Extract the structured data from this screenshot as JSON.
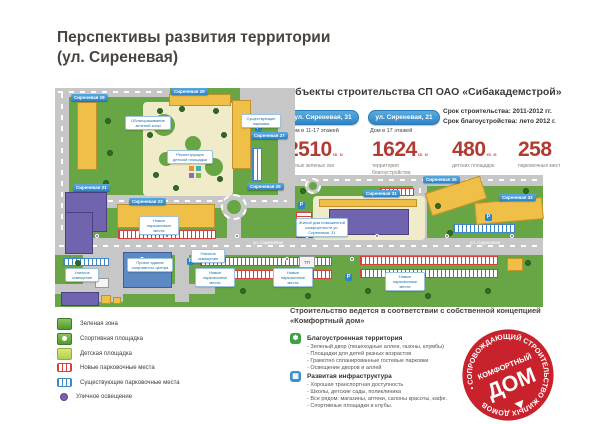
{
  "title": {
    "line1": "Перспективы развития территории",
    "line2": "(ул. Сиреневая)"
  },
  "objects": {
    "heading": "Объекты строительства СП ОАО «Сибакадемстрой»",
    "buildings": [
      {
        "button": "ул. Сиреневая, 31",
        "subtitle": "Дом в 11-17 этажей"
      },
      {
        "button": "ул. Сиреневая, 21",
        "subtitle": "Дом в 17 этажей"
      }
    ],
    "terms": [
      "Срок строительства: 2011-2012 гг.",
      "Срок благоустройства: лето 2012 г."
    ],
    "stats": [
      {
        "value": "2510",
        "unit": "кв. м",
        "label": "уютных зеленых зон"
      },
      {
        "value": "1624",
        "unit": "кв. м",
        "label": "территория благоустройства"
      },
      {
        "value": "480",
        "unit": "кв. м",
        "label": "детских площадок"
      },
      {
        "value": "258",
        "unit": "",
        "label": "парковочных мест"
      }
    ]
  },
  "map": {
    "street_name": "ул. Сиреневая",
    "p": "P",
    "tp_label": "ТП",
    "building_labels": [
      "Сиреневая 19",
      "Сиреневая 29",
      "Сиреневая 27",
      "Сиреневая 25",
      "Сиреневая 21",
      "Сиреневая 23",
      "Сиреневая 31",
      "Сиреневая 35",
      "Сиреневая 33"
    ],
    "callouts": [
      "Облагораживание зеленой зоны",
      "Реконструкция детской площадки",
      "Существующие парковки",
      "Новые парковочные места",
      "Проект здания спортивного центра",
      "Уличное освещение",
      "Уличное освещение",
      "Новые парковочные места",
      "Новые парковочные места",
      "Новые парковочные места",
      "Жилой дом повышенной комфортности ул. Сиреневая, 31"
    ]
  },
  "legend": {
    "items": [
      "Зеленая зона",
      "Спортивная площадка",
      "Детская площадка",
      "Новые парковочные места",
      "Существующие парковочные места",
      "Уличное освещение"
    ]
  },
  "concept": {
    "heading": "Строительство ведется в соответствии с собственной концепцией «Комфортный дом»",
    "groups": [
      {
        "icon_char": "✽",
        "title": "Благоустроенная территория",
        "bullets": [
          "Зеленый двор (пешеходные аллеи, газоны, клумбы)",
          "Площадки для детей разных возрастов",
          "Грамотно спланированные гостевые парковки",
          "Освещение дворов и аллей"
        ]
      },
      {
        "icon_char": "▦",
        "title": "Развитая инфраструктура",
        "bullets": [
          "Хорошая транспортная доступность",
          "Школы, детские сады, поликлиника",
          "Все рядом: магазины, аптеки, салоны красоты, кафе.",
          "Спортивные площадки и клубы."
        ]
      }
    ]
  },
  "stamp": {
    "ring_text": "• СОПРОВОЖДАЮЩИЙ СТРОИТЕЛЬСТВО ЖИЛЫХ ДОМОВ",
    "center_small": "КОМФОРТНЫЙ",
    "center_big": "ДОМ"
  },
  "colors": {
    "accent_blue": "#2e84c6",
    "stat_red": "#b23b33",
    "map_green": "#68a544",
    "road_gray": "#c7c7c7",
    "building_yellow": "#efbf48",
    "building_purple": "#6f64ad",
    "new_parking_red": "#d84040",
    "existing_parking_blue": "#3f87c7",
    "stamp_red": "#c8232c"
  }
}
